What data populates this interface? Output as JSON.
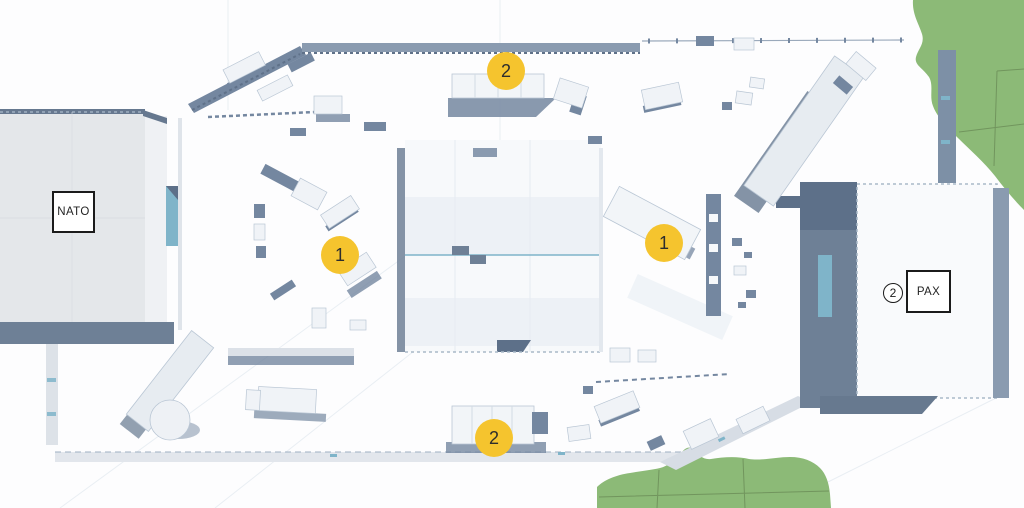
{
  "map": {
    "zone_labels": [
      {
        "id": "nato",
        "text": "NATO"
      },
      {
        "id": "pax",
        "text": "PAX"
      }
    ],
    "markers": [
      {
        "id": "objective-2-top",
        "label": "2",
        "style": "filled"
      },
      {
        "id": "objective-1-left",
        "label": "1",
        "style": "filled"
      },
      {
        "id": "objective-1-right",
        "label": "1",
        "style": "filled"
      },
      {
        "id": "objective-2-bottom",
        "label": "2",
        "style": "filled"
      },
      {
        "id": "pax-count",
        "label": "2",
        "style": "outlined"
      }
    ],
    "colors": {
      "marker_yellow": "#F5C42E",
      "terrain_green": "#8CBA77",
      "terrain_green_line": "#5B7748",
      "wall_slate": "#7487A0",
      "wall_slate_dark": "#5D7089",
      "accent_teal": "#7FB4C9",
      "roof_light": "#E4E7EA",
      "background": "#FDFDFE"
    }
  }
}
